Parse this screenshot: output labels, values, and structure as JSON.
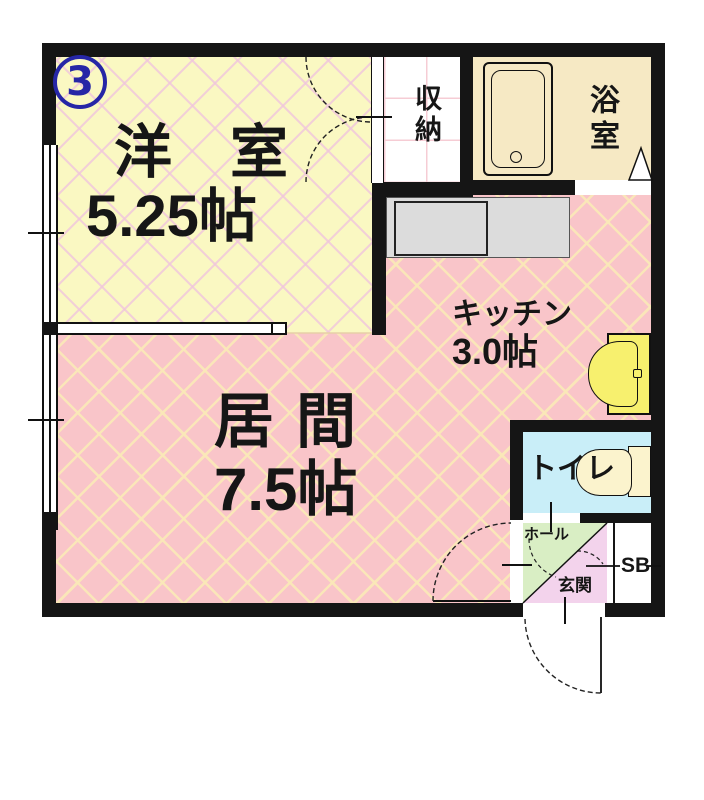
{
  "plan": {
    "unit_number": "3",
    "rooms": {
      "western_room": {
        "name": "洋室",
        "size": "5.25帖"
      },
      "living_room": {
        "name": "居間",
        "size": "7.5帖"
      },
      "kitchen": {
        "name": "キッチン",
        "size": "3.0帖"
      },
      "storage": {
        "name": "収納"
      },
      "bathroom": {
        "name": "浴室"
      },
      "toilet": {
        "name": "トイレ"
      },
      "hall": {
        "name": "ホール"
      },
      "entrance": {
        "name": "玄関"
      },
      "shoe_box": {
        "name": "SB"
      }
    },
    "colors": {
      "western_room_fill": "#faf8c2",
      "western_room_lattice": "#f0c6dc",
      "living_fill": "#f9c5c9",
      "living_lattice": "#fae8b8",
      "bathroom_fill": "#f6e9c4",
      "toilet_fill": "#c9eef8",
      "hall_fill": "#d9eec4",
      "entrance_fill": "#f3d3ec",
      "counter_fill": "#dcdcdc",
      "fixture_yellow": "#f7f06e",
      "fixture_cream": "#fbf3cd",
      "wall": "#151515",
      "unit_badge": "#2626a6"
    }
  }
}
